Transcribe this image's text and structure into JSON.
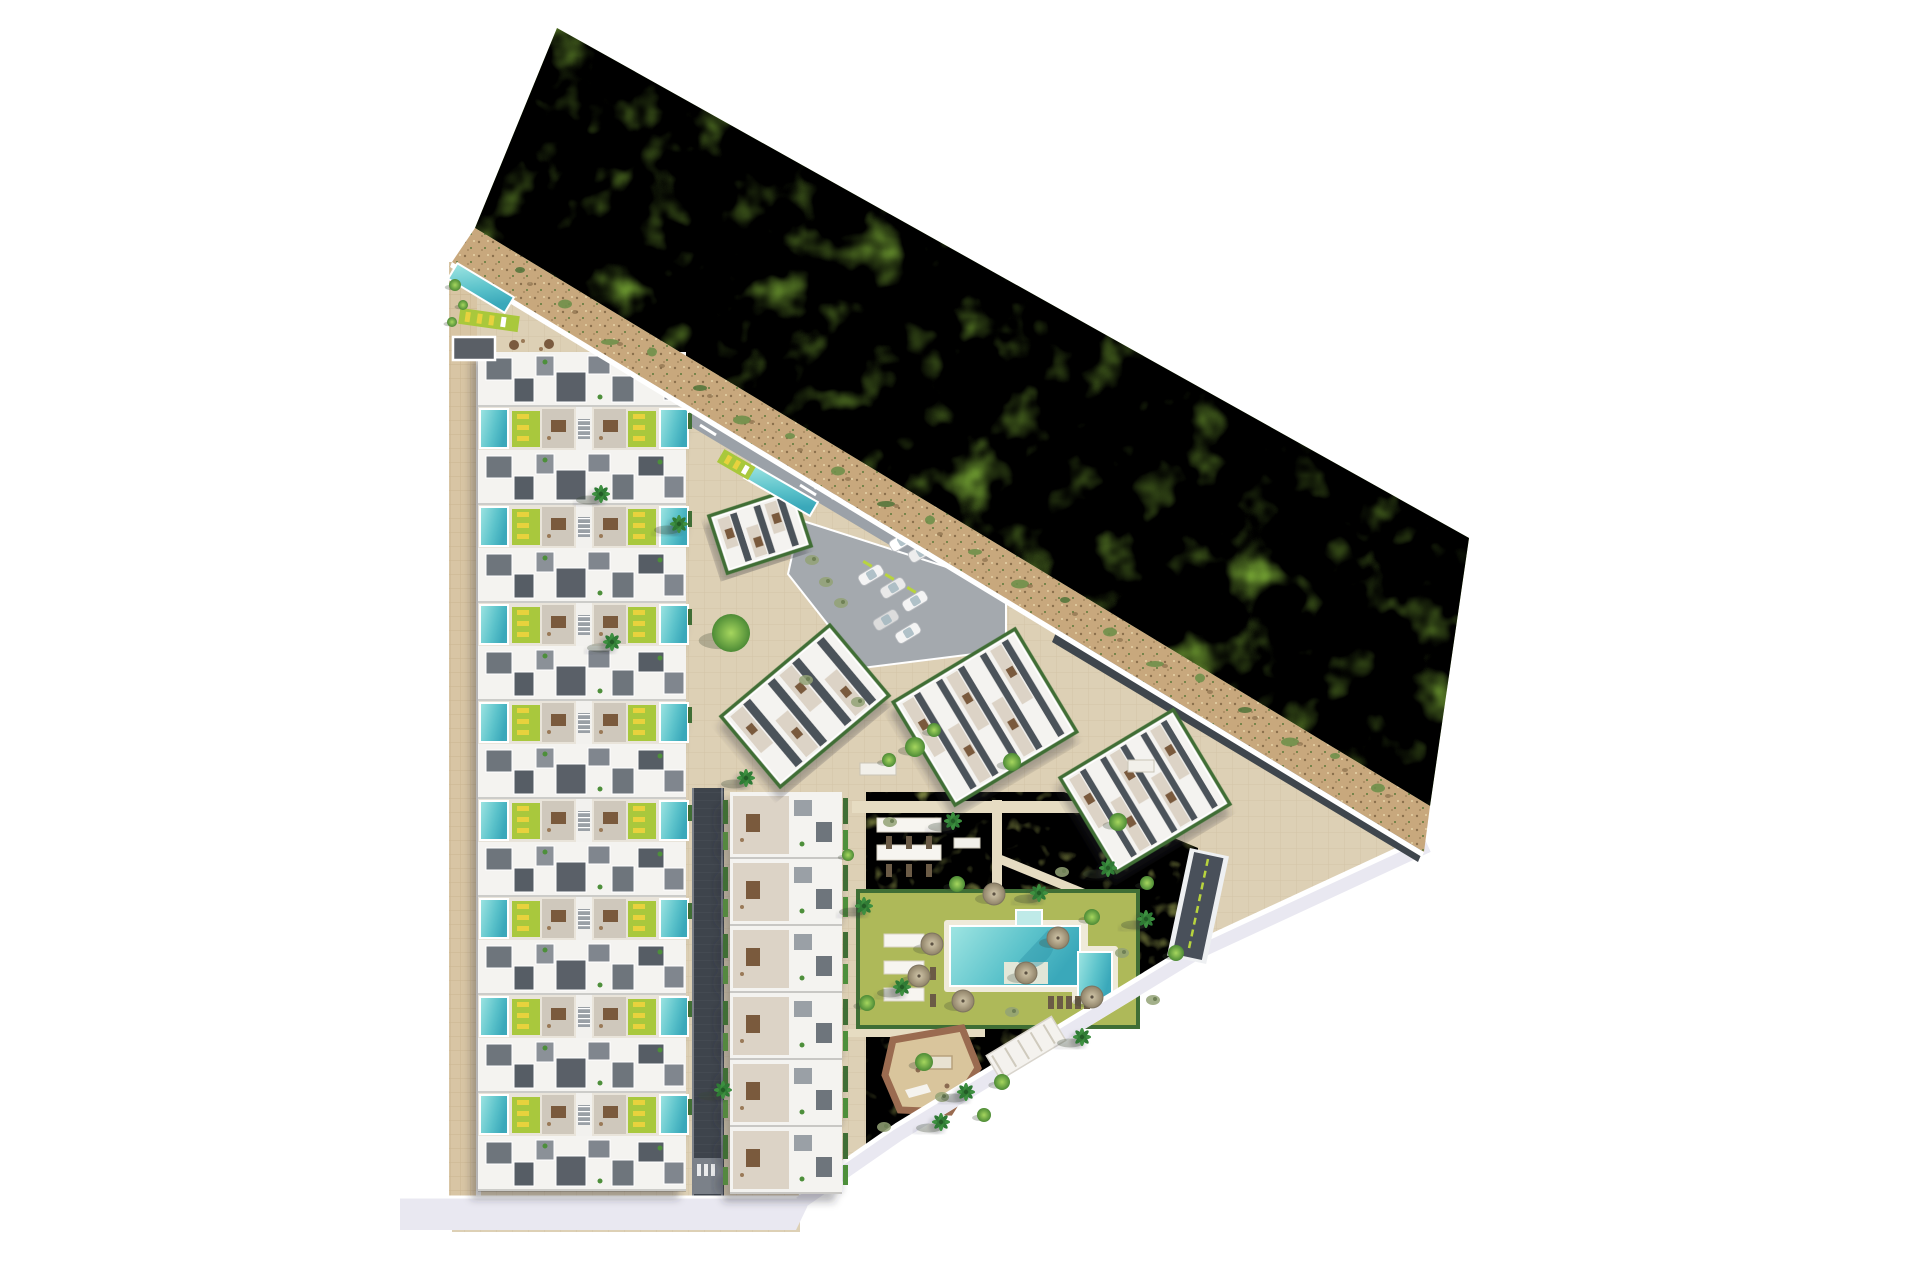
{
  "scene": {
    "description": "Aerial top-down 3D render of a residential masterplan: rows of townhouses with private pools on the left, tilted apartment blocks and parking in the centre, communal garden with large pool and playground, bounded by a sandy path and a large green field to the north-east",
    "image_type": "architectural-site-plan"
  },
  "palette": {
    "bg": "#ffffff",
    "field": "#8ec73f",
    "field_dark": "#76ad30",
    "sand": "#c8a87d",
    "plaza": "#ddd0b5",
    "sidewalk": "#d8c5a4",
    "asphalt": "#9ba1a8",
    "dark_road": "#3e444c",
    "bottom_road": "#e9e8f1",
    "roof_white": "#f4f3f0",
    "deck_gray": "#6e747c",
    "deck_dark": "#565c64",
    "terrace": "#cfc8bc",
    "cream": "#dcd3c6",
    "pool_light": "#9fe5e2",
    "pool_deep": "#3fb0c0",
    "lime": "#a9c83c",
    "lounger_yellow": "#e8d23e",
    "hedge": "#3f6e35",
    "lawn": "#b4be5e",
    "lawn_dark": "#97a648",
    "play_border": "#9a6b50",
    "play_sand": "#d9c59c",
    "table_brown": "#7a5a3e",
    "umbrella": "#c0b396",
    "ramp": "#49505a",
    "lime_line": "#b8d43e"
  },
  "townhouses": {
    "x": 478,
    "width": 208,
    "top": 352,
    "rows": 9,
    "row_period": 98,
    "roof_h": 55,
    "band_h": 43
  },
  "middle_slab": {
    "x": 730,
    "y": 792,
    "w": 112,
    "unit_h": 67,
    "units": 6
  },
  "blocks": [
    {
      "id": "amenity",
      "cx": 760,
      "cy": 531,
      "w": 88,
      "h": 60,
      "angle": -18,
      "bays": 3
    },
    {
      "id": "A",
      "cx": 805,
      "cy": 706,
      "w": 142,
      "h": 92,
      "angle": -40,
      "bays": 4
    },
    {
      "id": "B",
      "cx": 985,
      "cy": 717,
      "w": 142,
      "h": 120,
      "angle": -31,
      "bays": 5
    },
    {
      "id": "C",
      "cx": 1145,
      "cy": 791,
      "w": 132,
      "h": 110,
      "angle": -31,
      "bays": 5
    }
  ],
  "parking": {
    "poly": "800,520 1006,586 1006,650 862,668 788,574",
    "dark_cars": [
      [
        822,
        474
      ],
      [
        839,
        484
      ],
      [
        856,
        494
      ],
      [
        873,
        504
      ],
      [
        890,
        514
      ],
      [
        906,
        524
      ]
    ],
    "dark_car_colors": [
      "#2a211b",
      "#3a2d22",
      "#1f1a16",
      "#43362a",
      "#2a211b",
      "#35291f"
    ],
    "light_cars": [
      [
        871,
        575
      ],
      [
        893,
        588
      ],
      [
        915,
        601
      ],
      [
        886,
        620
      ],
      [
        908,
        633
      ],
      [
        902,
        541
      ],
      [
        921,
        552
      ]
    ],
    "light_car_colors": [
      "#f4f4f4",
      "#e9e9e9",
      "#f4f4f4",
      "#dcdcdc",
      "#f4f4f4",
      "#ffffff",
      "#ededed"
    ],
    "lime_accents": [
      [
        864,
        560
      ],
      [
        886,
        573
      ],
      [
        908,
        586
      ]
    ]
  },
  "garden": {
    "pergola_strips": [
      [
        877,
        818,
        64,
        14
      ],
      [
        877,
        845,
        64,
        15
      ],
      [
        884,
        934,
        40,
        13
      ],
      [
        884,
        961,
        40,
        13
      ],
      [
        884,
        988,
        40,
        13
      ]
    ],
    "loungers": [
      [
        886,
        836
      ],
      [
        906,
        836
      ],
      [
        926,
        836
      ],
      [
        886,
        864
      ],
      [
        906,
        864
      ],
      [
        926,
        864
      ],
      [
        930,
        940
      ],
      [
        930,
        967
      ],
      [
        930,
        994
      ],
      [
        1048,
        996
      ],
      [
        1057,
        996
      ],
      [
        1066,
        996
      ],
      [
        1075,
        996
      ],
      [
        1084,
        996
      ]
    ],
    "umbrellas": [
      [
        932,
        944
      ],
      [
        963,
        1001
      ],
      [
        994,
        894
      ],
      [
        1058,
        938
      ],
      [
        1092,
        997
      ],
      [
        919,
        976
      ],
      [
        1026,
        973
      ]
    ],
    "benches": [
      [
        860,
        763,
        36,
        12
      ],
      [
        954,
        838,
        26,
        10
      ],
      [
        1128,
        760,
        26,
        12
      ]
    ]
  },
  "trees": {
    "palms": [
      [
        601,
        494
      ],
      [
        679,
        524
      ],
      [
        612,
        642
      ],
      [
        746,
        778
      ],
      [
        864,
        906
      ],
      [
        953,
        821
      ],
      [
        1039,
        893
      ],
      [
        902,
        987
      ],
      [
        1082,
        1037
      ],
      [
        941,
        1122
      ],
      [
        966,
        1092
      ],
      [
        1146,
        919
      ],
      [
        723,
        1090
      ],
      [
        1108,
        868
      ]
    ],
    "round": [
      [
        731,
        633,
        19
      ],
      [
        915,
        747,
        10
      ],
      [
        1012,
        762,
        9
      ],
      [
        1118,
        822,
        9
      ],
      [
        957,
        884,
        8
      ],
      [
        1092,
        917,
        8
      ],
      [
        924,
        1062,
        9
      ],
      [
        1002,
        1082,
        8
      ],
      [
        867,
        1003,
        8
      ],
      [
        1147,
        883,
        7
      ],
      [
        889,
        760,
        7
      ],
      [
        1176,
        953,
        8
      ],
      [
        934,
        730,
        7
      ],
      [
        984,
        1115,
        7
      ],
      [
        455,
        285,
        6
      ],
      [
        463,
        305,
        5
      ],
      [
        452,
        322,
        5
      ],
      [
        848,
        855,
        6
      ]
    ],
    "shrubs": [
      [
        812,
        560
      ],
      [
        826,
        582
      ],
      [
        841,
        603
      ],
      [
        890,
        822
      ],
      [
        1062,
        872
      ],
      [
        1122,
        953
      ],
      [
        942,
        1097
      ],
      [
        1012,
        1012
      ],
      [
        1153,
        1000
      ],
      [
        884,
        1127
      ],
      [
        806,
        680
      ],
      [
        858,
        702
      ]
    ]
  },
  "sand_bushes": [
    [
      520,
      270
    ],
    [
      565,
      298
    ],
    [
      610,
      330
    ],
    [
      652,
      352
    ],
    [
      700,
      382
    ],
    [
      742,
      408
    ],
    [
      790,
      436
    ],
    [
      838,
      465
    ],
    [
      886,
      492
    ],
    [
      930,
      520
    ],
    [
      975,
      546
    ],
    [
      1020,
      572
    ],
    [
      1065,
      600
    ],
    [
      1110,
      626
    ],
    [
      1155,
      652
    ],
    [
      1200,
      678
    ],
    [
      1245,
      704
    ],
    [
      1290,
      730
    ],
    [
      1335,
      756
    ],
    [
      1378,
      782
    ]
  ]
}
